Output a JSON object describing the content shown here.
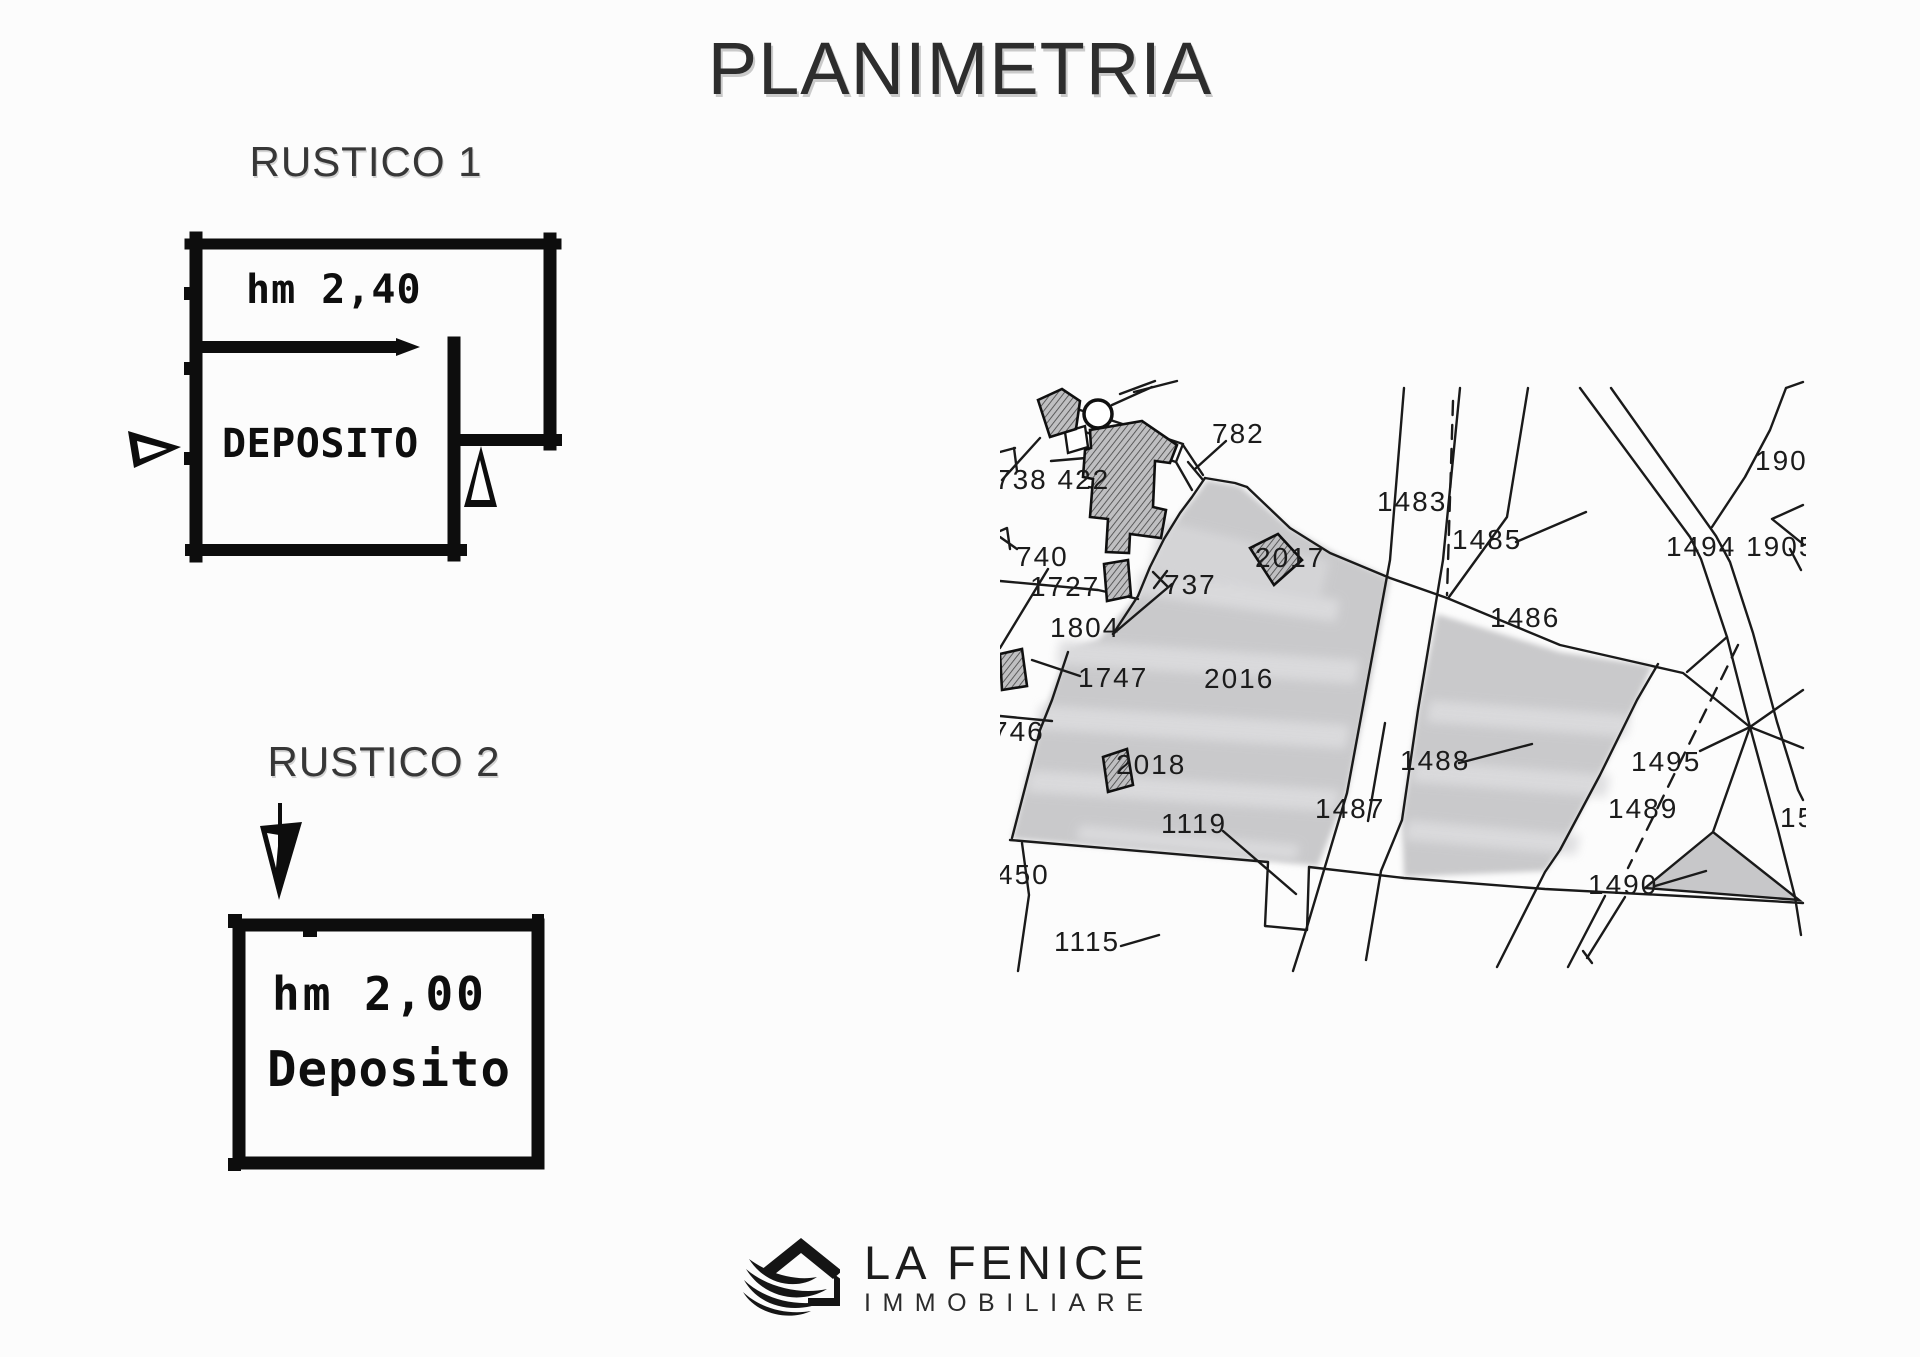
{
  "title": "PLANIMETRIA",
  "rustico1": {
    "label": "RUSTICO 1",
    "height_note": "hm 2,40",
    "room_name": "DEPOSITO"
  },
  "rustico2": {
    "label": "RUSTICO 2",
    "height_note": "hm 2,00",
    "room_name": "Deposito"
  },
  "logo": {
    "name": "LA FENICE",
    "subtitle": "IMMOBILIARE"
  },
  "map": {
    "colors": {
      "parcel_fill": "#c9c9cb",
      "band_fill": "#dcdcde",
      "line_ink": "#1a1a1a",
      "hatch_base": "#bfbfc1"
    },
    "labels": [
      {
        "text": "782",
        "x": 1212,
        "y": 443
      },
      {
        "text": "738 422",
        "x": 995,
        "y": 489
      },
      {
        "text": "1483",
        "x": 1377,
        "y": 511
      },
      {
        "text": "1485",
        "x": 1452,
        "y": 549
      },
      {
        "text": "190",
        "x": 1755,
        "y": 470
      },
      {
        "text": "1494 1905",
        "x": 1666,
        "y": 556
      },
      {
        "text": "740",
        "x": 1016,
        "y": 566
      },
      {
        "text": "1727",
        "x": 1030,
        "y": 596
      },
      {
        "text": "737",
        "x": 1164,
        "y": 594
      },
      {
        "text": "2017",
        "x": 1255,
        "y": 567
      },
      {
        "text": "1804",
        "x": 1050,
        "y": 637
      },
      {
        "text": "1486",
        "x": 1490,
        "y": 627
      },
      {
        "text": "1747",
        "x": 1078,
        "y": 687
      },
      {
        "text": "2016",
        "x": 1204,
        "y": 688,
        "size": 43
      },
      {
        "text": "746",
        "x": 992,
        "y": 741
      },
      {
        "text": "2018",
        "x": 1116,
        "y": 774
      },
      {
        "text": "1488",
        "x": 1400,
        "y": 770
      },
      {
        "text": "1495",
        "x": 1631,
        "y": 771
      },
      {
        "text": "1487",
        "x": 1315,
        "y": 818
      },
      {
        "text": "1489",
        "x": 1608,
        "y": 818
      },
      {
        "text": "1119",
        "x": 1161,
        "y": 833
      },
      {
        "text": "1490",
        "x": 1588,
        "y": 894
      },
      {
        "text": "450",
        "x": 997,
        "y": 884
      },
      {
        "text": "1115",
        "x": 1054,
        "y": 951
      },
      {
        "text": "15",
        "x": 1780,
        "y": 827
      }
    ]
  }
}
